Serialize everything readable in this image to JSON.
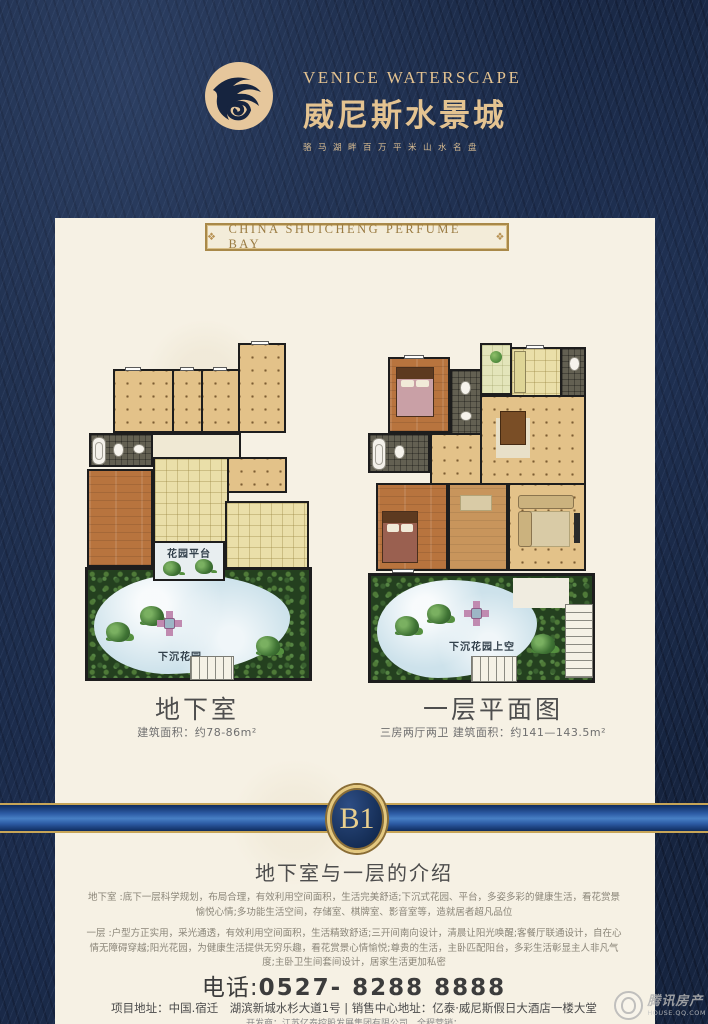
{
  "header": {
    "logo_title_en": "VENICE WATERSCAPE",
    "logo_title_cn": "威尼斯水景城",
    "logo_tagline": "骆马湖畔百万平米山水名盘",
    "banner": "CHINA SHUICHENG PERFUME BAY"
  },
  "icons": {
    "banner_ornament": "❖"
  },
  "plans": {
    "left": {
      "title": "地下室",
      "subtitle": "建筑面积：约78-86m²",
      "garden_platform_label": "花园平台",
      "sunken_garden_label": "下沉花园"
    },
    "right": {
      "title": "一层平面图",
      "subtitle": "三房两厅两卫 建筑面积：约141—143.5m²",
      "sunken_garden_label": "下沉花园上空"
    }
  },
  "badge": {
    "label": "B1"
  },
  "intro": {
    "title": "地下室与一层的介绍",
    "paragraph1": "地下室 :底下一层科学规划，布局合理，有效利用空间面积，生活完美舒适;下沉式花园、平台，多姿多彩的健康生活，看花赏景愉悦心情;多功能生活空间，存储室、棋牌室、影音室等，造就居者超凡品位",
    "paragraph2": "一层 :户型方正实用，采光通透，有效利用空间面积，生活精致舒适;三开间南向设计，清晨让阳光唤醒;客餐厅联通设计，自在心情无障碍穿越;阳光花园，为健康生活提供无穷乐趣，看花赏景心情愉悦;尊贵的生活，主卧匹配阳台，多彩生活彰显主人非凡气度;主卧卫生间套间设计，居家生活更加私密"
  },
  "contact": {
    "phone_label": "电话:",
    "phone_number": "0527- 8288 8888",
    "address": "项目地址：中国.宿迁　湖滨新城水杉大道1号 | 销售中心地址：亿泰·威尼斯假日大酒店一楼大堂",
    "developer_line": "开发商：江苏亿泰控股发展集团有限公司　全程营销："
  },
  "watermark": {
    "name_cn": "腾讯房产",
    "domain": "HOUSE.QQ.COM"
  },
  "colors": {
    "navy_frame": "#16243f",
    "gold": "#e4c391",
    "cream_panel": "#f6f1e4",
    "band_blue": "#2c5aa3",
    "band_gold_line": "#c7a557",
    "floor_tan": "#e3c289",
    "garden_green": "#24401f",
    "water_blue": "#cde2eb"
  }
}
